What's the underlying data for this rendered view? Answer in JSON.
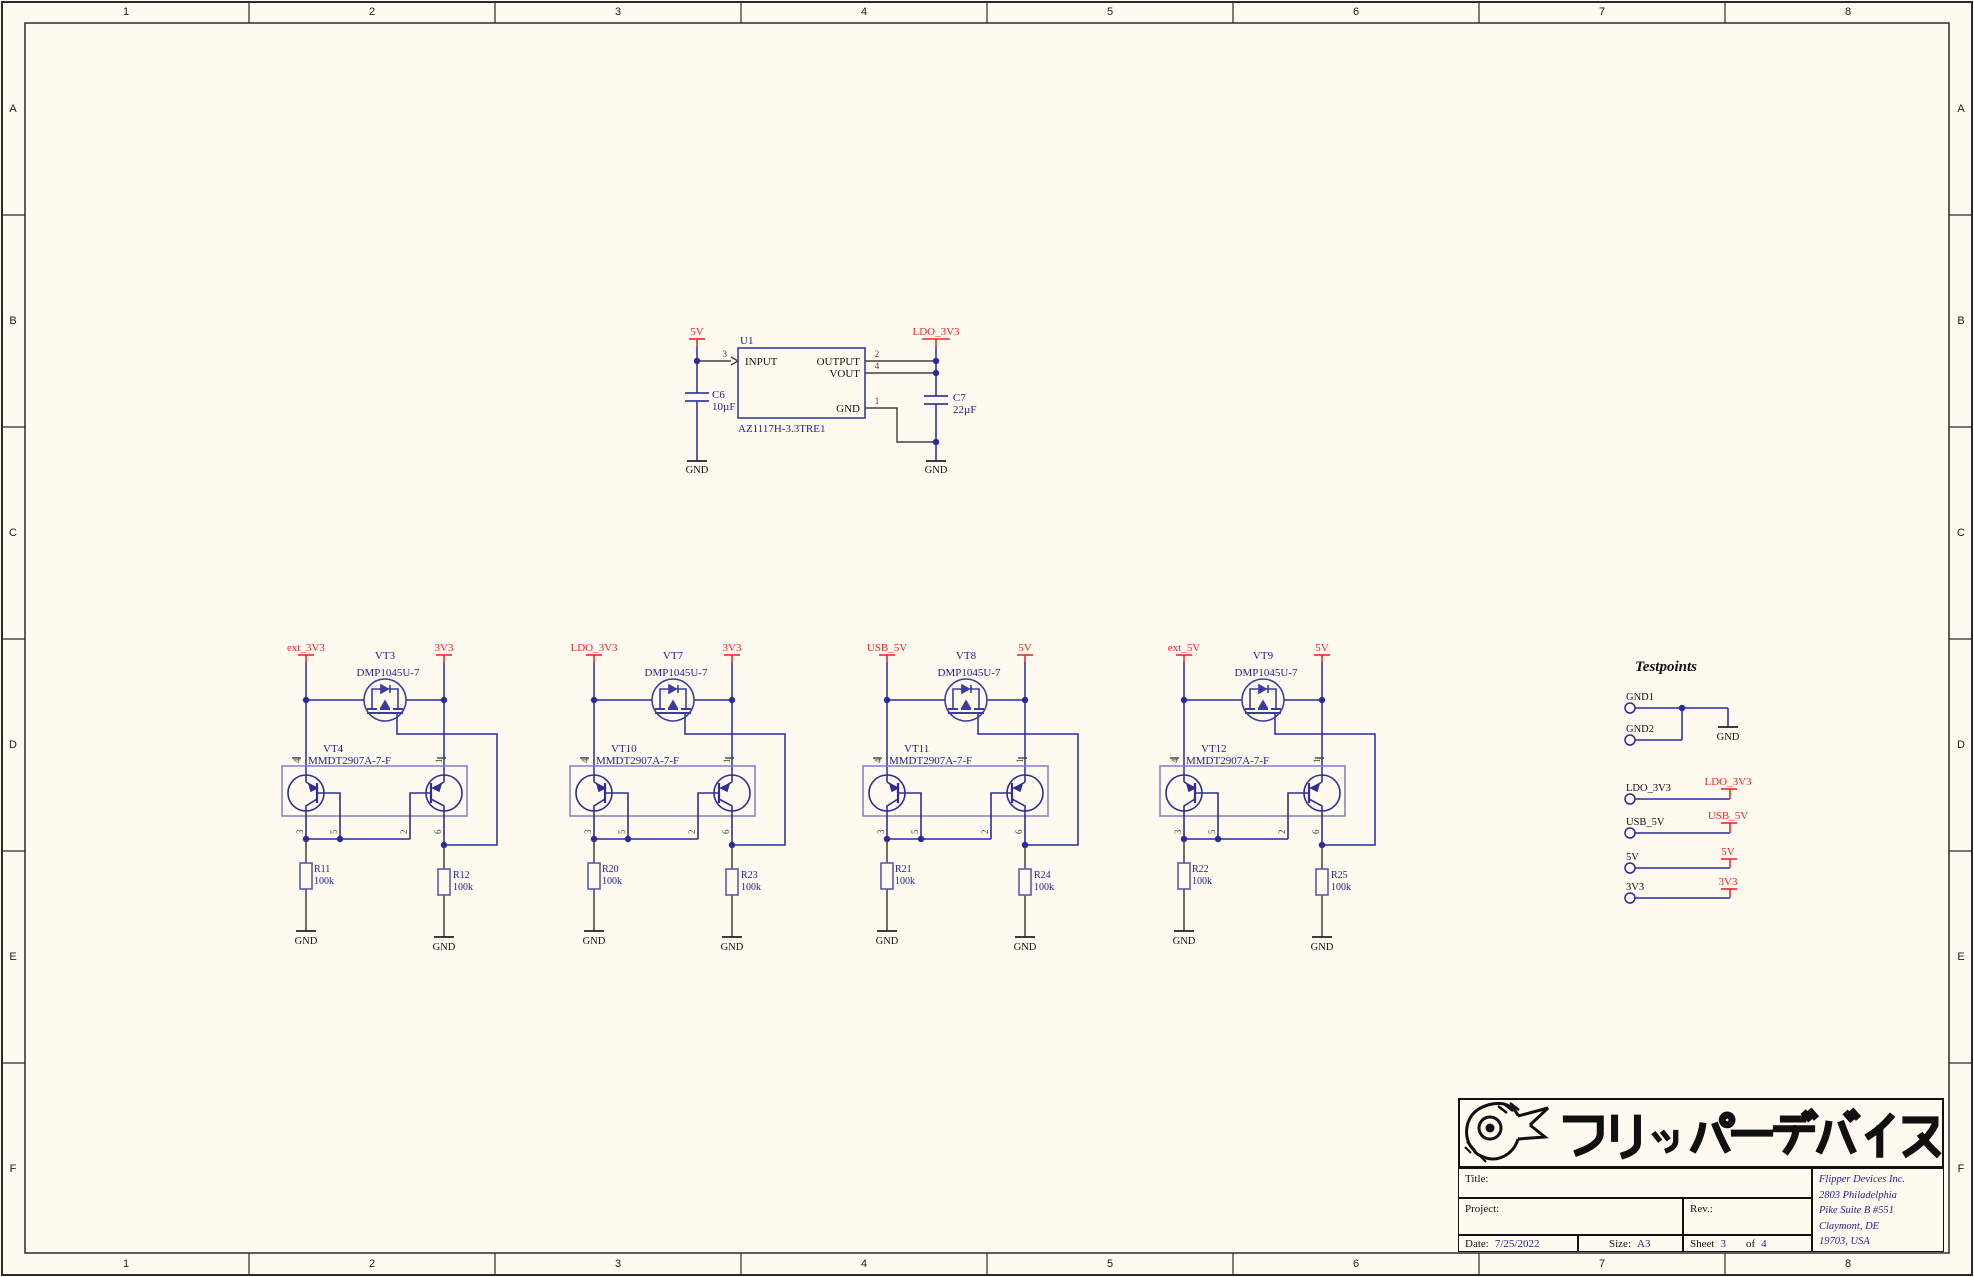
{
  "colors": {
    "background": "#FFFAF0",
    "wire": "#2929A3",
    "component_outline": "#3C3CA0",
    "bjt_box": "#8080C0",
    "pin_wire": "#3F3F3F",
    "net_label": "#FF2222",
    "designator_text": "#20208C",
    "testpoints_title": "#3A66C4",
    "frame": "#2A2A2A"
  },
  "border": {
    "columns": [
      "1",
      "2",
      "3",
      "4",
      "5",
      "6",
      "7",
      "8"
    ],
    "rows": [
      "A",
      "B",
      "C",
      "D",
      "E",
      "F"
    ]
  },
  "regulator": {
    "input_net": "5V",
    "output_net": "LDO_3V3",
    "ref": "U1",
    "part": "AZ1117H-3.3TRE1",
    "pin_input_num": "3",
    "pin_input_name": "INPUT",
    "pin_output_num": "2",
    "pin_output_name": "OUTPUT",
    "pin_vout_num": "4",
    "pin_vout_name": "VOUT",
    "pin_gnd_num": "1",
    "pin_gnd_name": "GND",
    "cap_in_ref": "C6",
    "cap_in_value": "10µF",
    "cap_out_ref": "C7",
    "cap_out_value": "22µF"
  },
  "labels": {
    "gnd": "GND"
  },
  "bjt_pins": {
    "top_left": "4",
    "top_right": "1",
    "b0": "3",
    "b1": "5",
    "b2": "2",
    "b3": "6"
  },
  "switches": [
    {
      "left_net": "ext_3V3",
      "right_net": "3V3",
      "mosfet_ref": "VT3",
      "mosfet_part": "DMP1045U-7",
      "bjt_ref": "VT4",
      "bjt_part": "MMDT2907A-7-F",
      "r_left_ref": "R11",
      "r_left_value": "100k",
      "r_right_ref": "R12",
      "r_right_value": "100k"
    },
    {
      "left_net": "LDO_3V3",
      "right_net": "3V3",
      "mosfet_ref": "VT7",
      "mosfet_part": "DMP1045U-7",
      "bjt_ref": "VT10",
      "bjt_part": "MMDT2907A-7-F",
      "r_left_ref": "R20",
      "r_left_value": "100k",
      "r_right_ref": "R23",
      "r_right_value": "100k"
    },
    {
      "left_net": "USB_5V",
      "right_net": "5V",
      "mosfet_ref": "VT8",
      "mosfet_part": "DMP1045U-7",
      "bjt_ref": "VT11",
      "bjt_part": "MMDT2907A-7-F",
      "r_left_ref": "R21",
      "r_left_value": "100k",
      "r_right_ref": "R24",
      "r_right_value": "100k"
    },
    {
      "left_net": "ext_5V",
      "right_net": "5V",
      "mosfet_ref": "VT9",
      "mosfet_part": "DMP1045U-7",
      "bjt_ref": "VT12",
      "bjt_part": "MMDT2907A-7-F",
      "r_left_ref": "R22",
      "r_left_value": "100k",
      "r_right_ref": "R25",
      "r_right_value": "100k"
    }
  ],
  "testpoints": {
    "title": "Testpoints",
    "gnd1": "GND1",
    "gnd2": "GND2",
    "items": [
      {
        "name": "LDO_3V3",
        "net": "LDO_3V3"
      },
      {
        "name": "USB_5V",
        "net": "USB_5V"
      },
      {
        "name": "5V",
        "net": "5V"
      },
      {
        "name": "3V3",
        "net": "3V3"
      }
    ]
  },
  "title_block": {
    "logo_text": "フリッパーデバイス",
    "title_label": "Title:",
    "project_label": "Project:",
    "rev_label": "Rev.:",
    "date_label": "Date:",
    "date_value": "7/25/2022",
    "size_label": "Size:",
    "size_value": "A3",
    "sheet_label": "Sheet",
    "sheet_number": "3",
    "of_label": "of",
    "sheet_total": "4",
    "company_line1": "Flipper Devices Inc.",
    "company_line2": "2803 Philadelphia",
    "company_line3": "Pike Suite B #551",
    "company_line4": "Claymont, DE",
    "company_line5": "19703, USA"
  }
}
